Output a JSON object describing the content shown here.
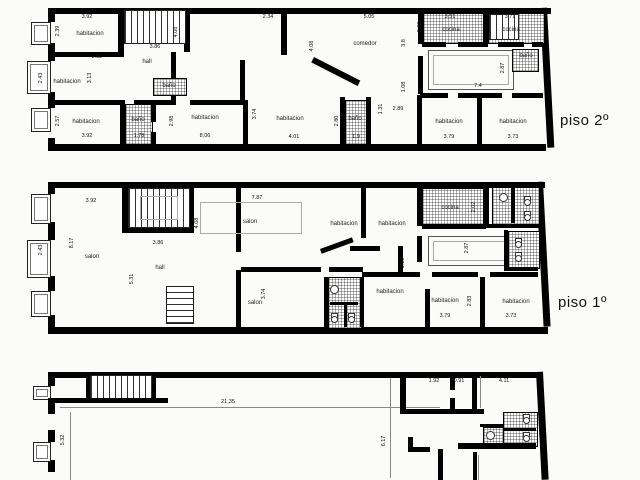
{
  "floors": [
    {
      "id": "piso2",
      "title": "piso 2º",
      "rooms": [
        {
          "t": "habitacion",
          "x": 90,
          "y": 34
        },
        {
          "t": "hall",
          "x": 147,
          "y": 62
        },
        {
          "t": "habitacion",
          "x": 67,
          "y": 82
        },
        {
          "t": "baño",
          "x": 169,
          "y": 86
        },
        {
          "t": "baño",
          "x": 138,
          "y": 120
        },
        {
          "t": "habitacion",
          "x": 86,
          "y": 122
        },
        {
          "t": "habitacion",
          "x": 205,
          "y": 118
        },
        {
          "t": "habitacion",
          "x": 290,
          "y": 119
        },
        {
          "t": "baño",
          "x": 355,
          "y": 119
        },
        {
          "t": "comedor",
          "x": 365,
          "y": 44
        },
        {
          "t": "cocina",
          "x": 451,
          "y": 30
        },
        {
          "t": "cocina",
          "x": 511,
          "y": 30
        },
        {
          "t": "baño",
          "x": 526,
          "y": 56
        },
        {
          "t": "habitacion",
          "x": 449,
          "y": 122
        },
        {
          "t": "habitacion",
          "x": 513,
          "y": 122
        }
      ],
      "dims": [
        {
          "t": "3.92",
          "x": 87,
          "y": 17
        },
        {
          "t": "2.39",
          "x": 58,
          "y": 31,
          "v": 1
        },
        {
          "t": "2.82",
          "x": 97,
          "y": 57
        },
        {
          "t": "3.13",
          "x": 90,
          "y": 78,
          "v": 1
        },
        {
          "t": "2.43",
          "x": 41,
          "y": 78,
          "v": 1
        },
        {
          "t": "3.86",
          "x": 155,
          "y": 47
        },
        {
          "t": "4.08",
          "x": 176,
          "y": 32,
          "v": 1
        },
        {
          "t": "2.34",
          "x": 268,
          "y": 17
        },
        {
          "t": "5.05",
          "x": 369,
          "y": 17
        },
        {
          "t": "4.08",
          "x": 312,
          "y": 46,
          "v": 1
        },
        {
          "t": "3.8",
          "x": 404,
          "y": 43,
          "v": 1
        },
        {
          "t": "2.02",
          "x": 420,
          "y": 27,
          "v": 1
        },
        {
          "t": "1.08",
          "x": 404,
          "y": 87,
          "v": 1
        },
        {
          "t": "3.51",
          "x": 450,
          "y": 17
        },
        {
          "t": "3.71",
          "x": 510,
          "y": 17
        },
        {
          "t": "7.4",
          "x": 478,
          "y": 86
        },
        {
          "t": "2.87",
          "x": 503,
          "y": 68,
          "v": 1
        },
        {
          "t": "2.57",
          "x": 58,
          "y": 121,
          "v": 1
        },
        {
          "t": "3.92",
          "x": 87,
          "y": 136
        },
        {
          "t": "1.78",
          "x": 139,
          "y": 136
        },
        {
          "t": "2.98",
          "x": 172,
          "y": 121,
          "v": 1
        },
        {
          "t": "8.06",
          "x": 205,
          "y": 136
        },
        {
          "t": "3.74",
          "x": 255,
          "y": 114,
          "v": 1
        },
        {
          "t": "4.01",
          "x": 294,
          "y": 137
        },
        {
          "t": "2.80",
          "x": 337,
          "y": 121,
          "v": 1
        },
        {
          "t": "1.9",
          "x": 356,
          "y": 137
        },
        {
          "t": "1.31",
          "x": 381,
          "y": 109,
          "v": 1
        },
        {
          "t": "2.89",
          "x": 398,
          "y": 109
        },
        {
          "t": "3.79",
          "x": 449,
          "y": 137
        },
        {
          "t": "3.73",
          "x": 513,
          "y": 137
        }
      ]
    },
    {
      "id": "piso1",
      "title": "piso 1º",
      "rooms": [
        {
          "t": "salon",
          "x": 92,
          "y": 257
        },
        {
          "t": "hall",
          "x": 160,
          "y": 268
        },
        {
          "t": "salon",
          "x": 250,
          "y": 222
        },
        {
          "t": "salon",
          "x": 255,
          "y": 303
        },
        {
          "t": "habitacion",
          "x": 344,
          "y": 224
        },
        {
          "t": "habitacion",
          "x": 392,
          "y": 224
        },
        {
          "t": "cocina",
          "x": 450,
          "y": 208
        },
        {
          "t": "habitacion",
          "x": 390,
          "y": 292
        },
        {
          "t": "habitacion",
          "x": 445,
          "y": 301
        },
        {
          "t": "habitacion",
          "x": 516,
          "y": 302
        }
      ],
      "dims": [
        {
          "t": "3.92",
          "x": 91,
          "y": 201
        },
        {
          "t": "8.17",
          "x": 72,
          "y": 243,
          "v": 1
        },
        {
          "t": "2.43",
          "x": 41,
          "y": 250,
          "v": 1
        },
        {
          "t": "3.86",
          "x": 158,
          "y": 243
        },
        {
          "t": "5.31",
          "x": 132,
          "y": 279,
          "v": 1
        },
        {
          "t": "7.87",
          "x": 257,
          "y": 198
        },
        {
          "t": "4.08",
          "x": 197,
          "y": 223,
          "v": 1
        },
        {
          "t": "3.74",
          "x": 264,
          "y": 294,
          "v": 1
        },
        {
          "t": "2.02",
          "x": 474,
          "y": 207,
          "v": 1
        },
        {
          "t": "2.87",
          "x": 467,
          "y": 248,
          "v": 1
        },
        {
          "t": "1.08",
          "x": 403,
          "y": 263,
          "v": 1
        },
        {
          "t": "2.83",
          "x": 470,
          "y": 301,
          "v": 1
        },
        {
          "t": "3.79",
          "x": 445,
          "y": 316
        },
        {
          "t": "3.73",
          "x": 511,
          "y": 316
        }
      ]
    },
    {
      "id": "baja",
      "title": "",
      "rooms": [],
      "dims": [
        {
          "t": "21,35",
          "x": 228,
          "y": 402
        },
        {
          "t": "5.32",
          "x": 63,
          "y": 440,
          "v": 1
        },
        {
          "t": "6.17",
          "x": 384,
          "y": 441,
          "v": 1
        },
        {
          "t": "1.92",
          "x": 434,
          "y": 381
        },
        {
          "t": "0.91",
          "x": 459,
          "y": 381
        },
        {
          "t": "4.11",
          "x": 504,
          "y": 381
        },
        {
          "t": "2.04",
          "x": 475,
          "y": 392,
          "v": 1
        }
      ]
    }
  ]
}
